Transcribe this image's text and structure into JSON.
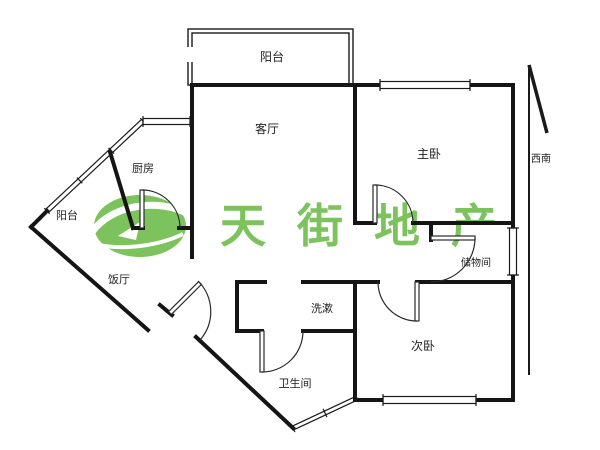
{
  "watermark": {
    "brand": "天街地产",
    "color": "#7cc35e"
  },
  "compass": {
    "label": "西南"
  },
  "rooms": {
    "balcony_top": "阳台",
    "living_room": "客厅",
    "master_bedroom": "主卧",
    "kitchen": "厨房",
    "balcony_left": "阳台",
    "dining_room": "饭厅",
    "storage_room": "储物间",
    "wash_area": "洗漱",
    "second_bedroom": "次卧",
    "bathroom": "卫生间"
  },
  "colors": {
    "wall": "#151515",
    "label": "#222222",
    "watermark_green": "#7cc35e"
  }
}
